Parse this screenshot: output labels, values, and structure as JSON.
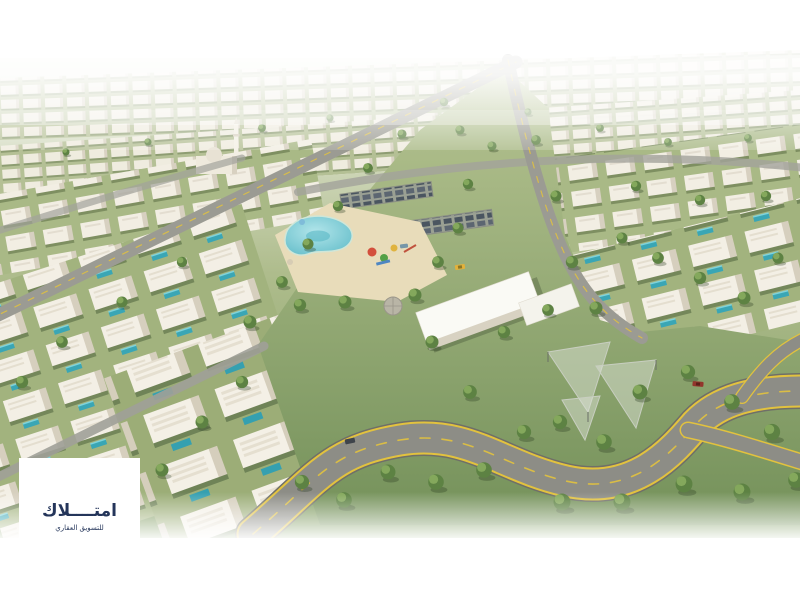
{
  "watermark": {
    "title_ar": "امتــــلاك",
    "tagline_ar": "للتسويق العقاري",
    "text_color": "#24355a",
    "bg_color": "#ffffff"
  },
  "palette": {
    "sky": "#ffffff",
    "haze": "#f2f4ec",
    "grass": "#a3b580",
    "grass_deep": "#7c9a5e",
    "building": "#f2eee3",
    "building_side": "#d7d0c0",
    "road": "#8d8d86",
    "road_dark": "#6f6f68",
    "lane_yellow": "#e2c23e",
    "pool": "#7fcdd8",
    "pool_deep": "#3aa6b5",
    "sand": "#e8dcba",
    "tree": "#5d8243",
    "tree_light": "#84a85c",
    "taxi_yellow": "#e2b13b",
    "car_red": "#93352c"
  }
}
